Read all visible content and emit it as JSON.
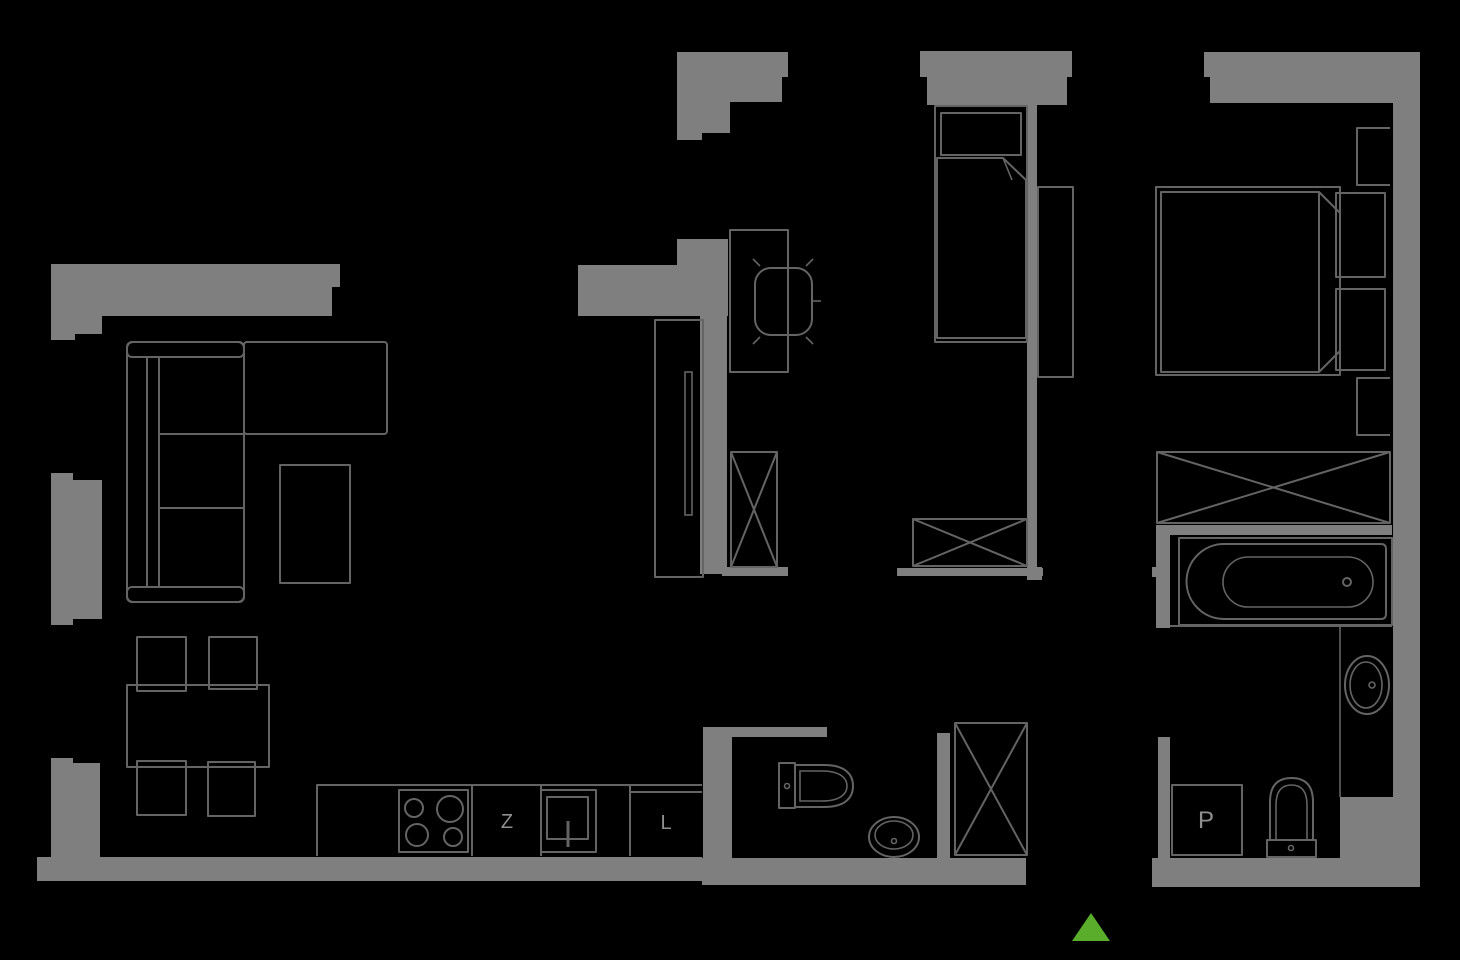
{
  "meta": {
    "type": "apartment-floor-plan",
    "style": "dark blueprint, gray walls on black background"
  },
  "palette": {
    "bg": "#000000",
    "wall": "#7f7f7f",
    "outline": "#646464",
    "label": "#8f8f8f",
    "entrance": "#5aad2b"
  },
  "labels": {
    "kitchen_sink": "Z",
    "fridge": "L",
    "washing_machine": "P"
  },
  "icons": {
    "entrance_marker": "triangle-up"
  }
}
